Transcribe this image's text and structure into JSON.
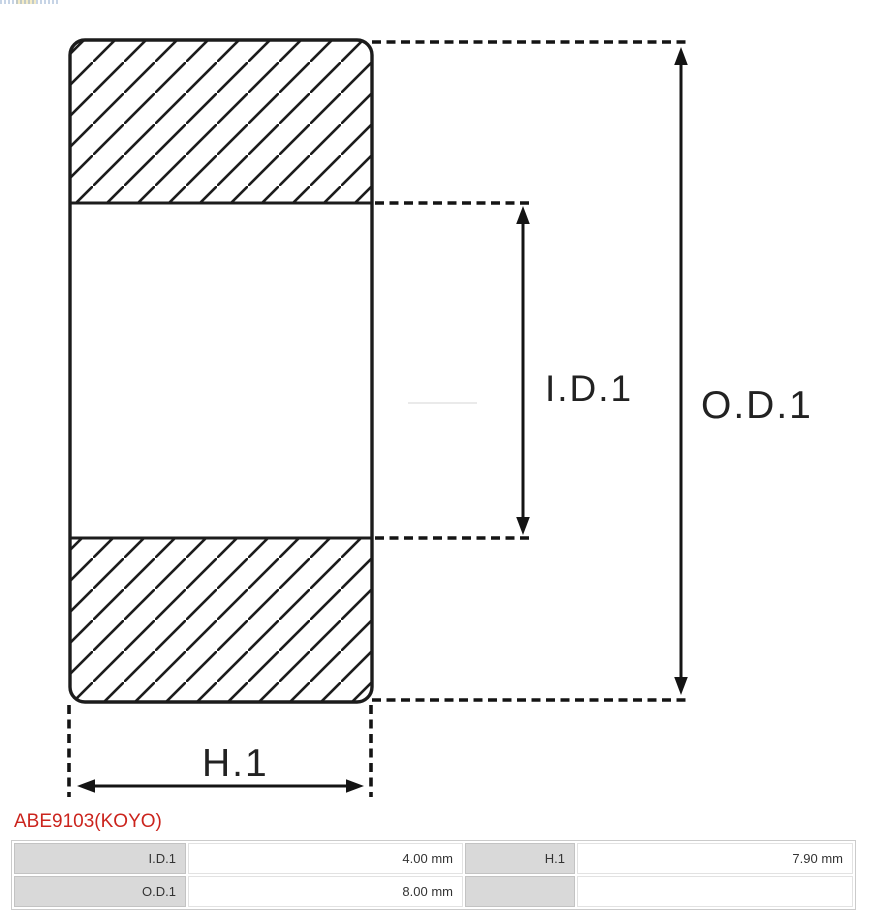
{
  "part": {
    "number": "ABE9103(KOYO)",
    "link_color": "#cb241d"
  },
  "diagram": {
    "labels": {
      "inner_diameter": "I.D.1",
      "outer_diameter": "O.D.1",
      "height": "H.1"
    },
    "stroke_color": "#1c1c1c"
  },
  "spec_table": {
    "label_bg": "#d9d9d9",
    "rows": [
      {
        "label1": "I.D.1",
        "value1": "4.00 mm",
        "label2": "H.1",
        "value2": "7.90 mm"
      },
      {
        "label1": "O.D.1",
        "value1": "8.00 mm",
        "label2": "",
        "value2": ""
      }
    ]
  }
}
